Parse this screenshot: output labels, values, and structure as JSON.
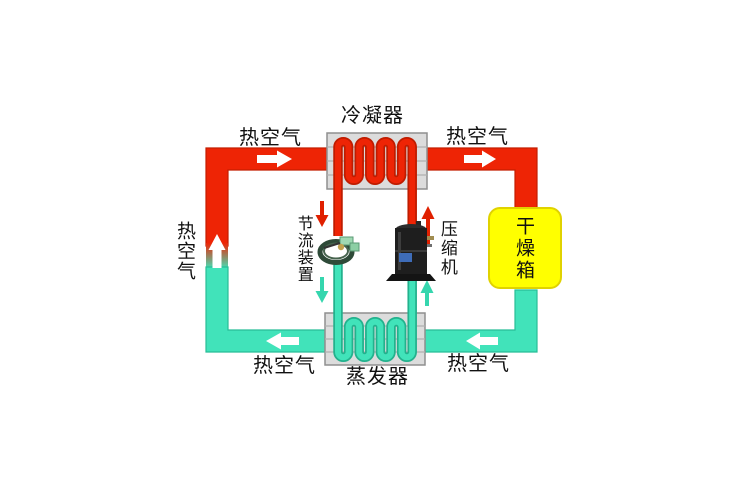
{
  "diagram": {
    "type": "heat-pump-dryer-refrigeration-cycle",
    "labels": {
      "condenser": "冷凝器",
      "evaporator": "蒸发器",
      "compressor": "压缩机",
      "throttle_device": "节流装置",
      "drying_box": "干燥箱",
      "hot_air_top_left": "热空气",
      "hot_air_top_right": "热空气",
      "hot_air_left_riser": "热空气",
      "hot_air_bottom_left": "热空气",
      "hot_air_bottom_right": "热空气"
    },
    "components": [
      {
        "name": "condenser",
        "label": "冷凝器",
        "desc": "gray finned box with red refrigerant serpentine coil, hot air duct passes through"
      },
      {
        "name": "evaporator",
        "label": "蒸发器",
        "desc": "gray finned box with teal refrigerant serpentine coil, return air duct passes through"
      },
      {
        "name": "compressor",
        "label": "压缩机",
        "desc": "black scroll compressor with blue nameplate and base flange"
      },
      {
        "name": "throttle-device",
        "label": "节流装置",
        "desc": "expansion valve with coiled capillary tube"
      },
      {
        "name": "drying-box",
        "label": "干燥箱",
        "desc": "yellow rounded box receiving hot air, returning moist air"
      }
    ],
    "arrows": [
      {
        "name": "airflow-arrow-top-left",
        "color": "white",
        "direction": "right"
      },
      {
        "name": "airflow-arrow-top-right",
        "color": "white",
        "direction": "right"
      },
      {
        "name": "airflow-arrow-left-riser",
        "color": "white",
        "direction": "up"
      },
      {
        "name": "airflow-arrow-bottom-left",
        "color": "white",
        "direction": "left"
      },
      {
        "name": "airflow-arrow-bottom-right",
        "color": "white",
        "direction": "left"
      },
      {
        "name": "refrigerant-arrow-condenser-to-throttle",
        "color": "red",
        "direction": "down"
      },
      {
        "name": "refrigerant-arrow-compressor-to-condenser",
        "color": "red",
        "direction": "up"
      },
      {
        "name": "refrigerant-arrow-throttle-to-evaporator",
        "color": "teal",
        "direction": "down"
      },
      {
        "name": "refrigerant-arrow-evaporator-to-compressor",
        "color": "teal",
        "direction": "up"
      }
    ],
    "colors": {
      "hot_air_red": "#ee2405",
      "hot_air_red_edge": "#c41d00",
      "cold_air_teal": "#41e3ba",
      "cold_air_teal_edge": "#28bd97",
      "drying_box_yellow": "#ffff00",
      "drying_box_edge": "#e0d200",
      "heat_exchanger_gray": "#dcdcdc",
      "heat_exchanger_edge": "#8f8f8f",
      "background": "#ffffff",
      "label_text": "#111111"
    }
  }
}
